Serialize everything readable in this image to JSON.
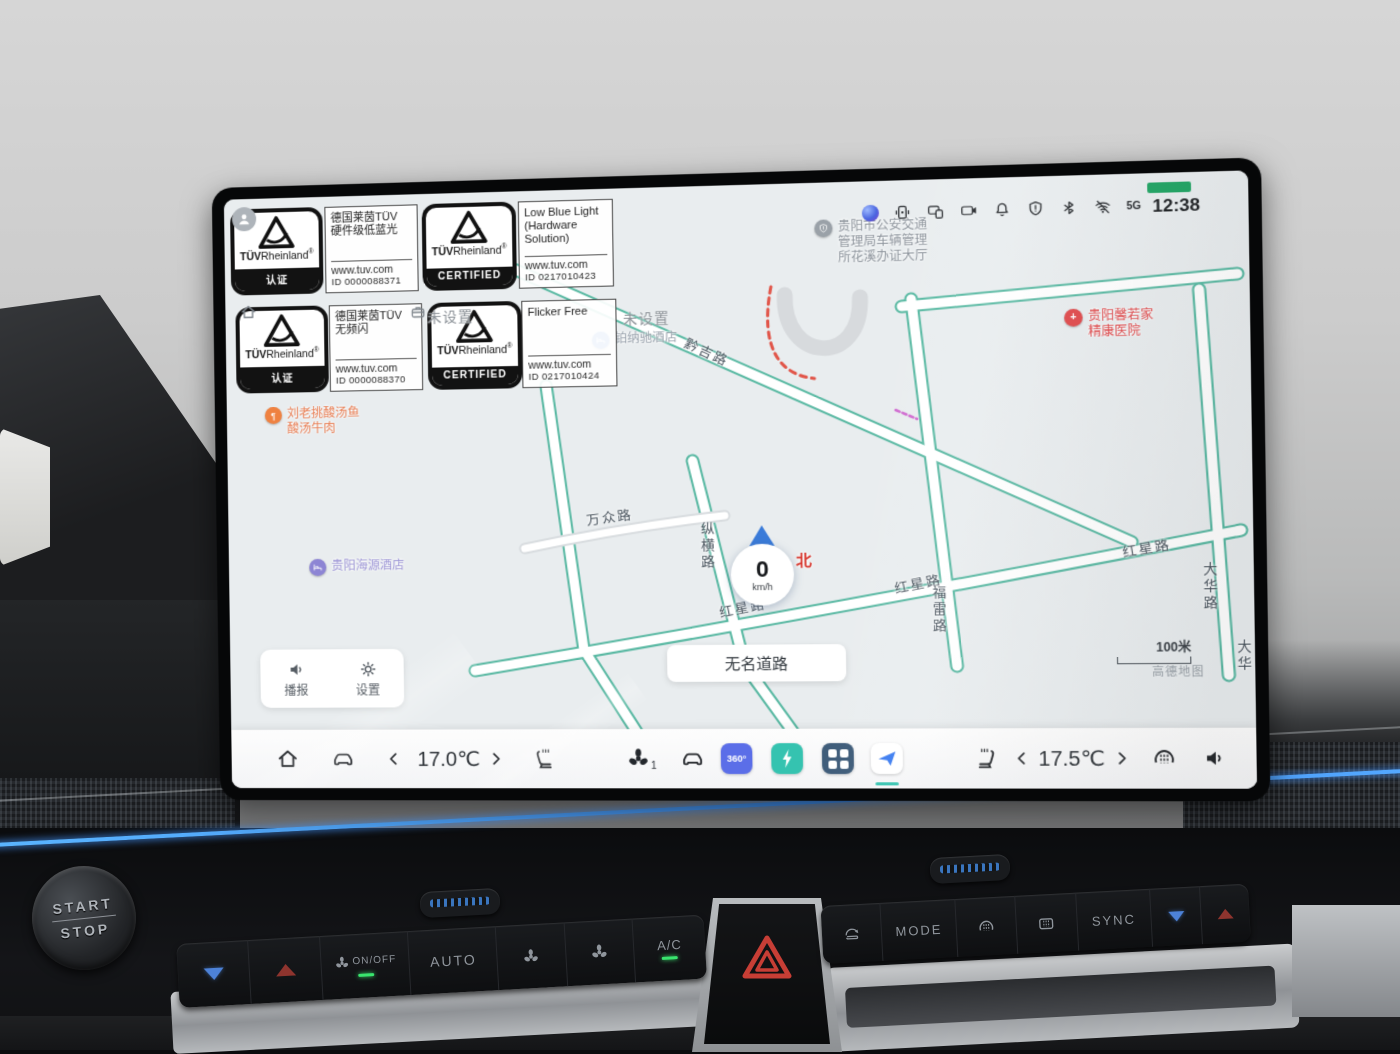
{
  "colors": {
    "accent_teal": "#35c3b0",
    "led_blue": "#4aa3f5",
    "road_green": "#49b39a",
    "map_background": "#e9edef",
    "alert_red": "#e0484a",
    "led_green": "#39e56e"
  },
  "screen": {
    "status_bar": {
      "time": "12:38",
      "signal_label": "5G"
    },
    "certifications": [
      {
        "brand_bold": "TÜV",
        "brand_rest": "Rheinland",
        "reg": "®",
        "mark": "认证",
        "line1": "德国莱茵TÜV",
        "line2": "硬件级低蓝光",
        "url": "www.tuv.com",
        "cert_id": "ID  0000088371"
      },
      {
        "brand_bold": "TÜV",
        "brand_rest": "Rheinland",
        "reg": "®",
        "mark": "CERTIFIED",
        "line1": "Low Blue Light",
        "line2": "(Hardware Solution)",
        "url": "www.tuv.com",
        "cert_id": "ID  0217010423"
      },
      {
        "brand_bold": "TÜV",
        "brand_rest": "Rheinland",
        "reg": "®",
        "mark": "认证",
        "line1": "德国莱茵TÜV",
        "line2": "无频闪",
        "url": "www.tuv.com",
        "cert_id": "ID  0000088370"
      },
      {
        "brand_bold": "TÜV",
        "brand_rest": "Rheinland",
        "reg": "®",
        "mark": "CERTIFIED",
        "line1": "Flicker Free",
        "line2": "",
        "url": "www.tuv.com",
        "cert_id": "ID  0217010424"
      }
    ],
    "map": {
      "shortcut_home": "未设置",
      "shortcut_work": "未设置",
      "road_labels": [
        "黔吉路",
        "万众路",
        "纵横路",
        "红星路",
        "红星路",
        "红星路",
        "福雷路",
        "大华路",
        "大华"
      ],
      "pois": {
        "police": "贵阳市公安交通\n管理局车辆管理\n所花溪办证大厅",
        "hotel_bonachi": "铂纳驰酒店",
        "hospital": "贵阳馨若家\n精康医院",
        "restaurant": "刘老挑酸汤鱼\n酸汤牛肉",
        "hotel_haiyuan": "贵阳海源酒店"
      },
      "vehicle": {
        "speed": "0",
        "unit": "km/h",
        "compass": "北"
      },
      "current_road": "无名道路",
      "scale": "100米",
      "attribution": "高德地图",
      "controls": {
        "broadcast": "播报",
        "settings": "设置"
      }
    },
    "dock": {
      "driver_temp": "17.0℃",
      "passenger_temp": "17.5℃",
      "fan_level": "1",
      "app_360": "360°"
    }
  },
  "console": {
    "start": "START",
    "stop": "STOP",
    "onoff": "ON/OFF",
    "auto": "AUTO",
    "ac": "A/C",
    "mode": "MODE",
    "sync": "SYNC"
  }
}
